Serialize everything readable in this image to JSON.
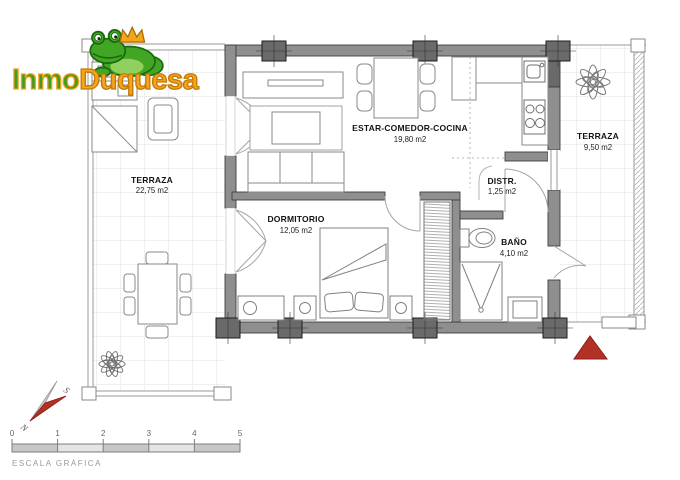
{
  "logo": {
    "inmo": "Inmo",
    "duquesa": "Duquesa"
  },
  "rooms": {
    "terraza_left": {
      "name": "TERRAZA",
      "area": "22,75 m2"
    },
    "estar": {
      "name": "ESTAR-COMEDOR-COCINA",
      "area": "19,80 m2"
    },
    "terraza_right": {
      "name": "TERRAZA",
      "area": "9,50 m2"
    },
    "distr": {
      "name": "DISTR.",
      "area": "1,25 m2"
    },
    "dormitorio": {
      "name": "DORMITORIO",
      "area": "12,05 m2"
    },
    "bano": {
      "name": "BAÑO",
      "area": "4,10 m2"
    }
  },
  "compass": {
    "south": "S",
    "north": "N"
  },
  "scale_bar": {
    "ticks": [
      "0",
      "1",
      "2",
      "3",
      "4",
      "5"
    ],
    "caption": "ESCALA GRÁFICA"
  },
  "colors": {
    "wall_gray": "#8f8f8f",
    "column_gray": "#6a6a6a",
    "marker_red": "#b23127",
    "logo_green": "#3f9e22",
    "logo_orange": "#f6a41c"
  }
}
